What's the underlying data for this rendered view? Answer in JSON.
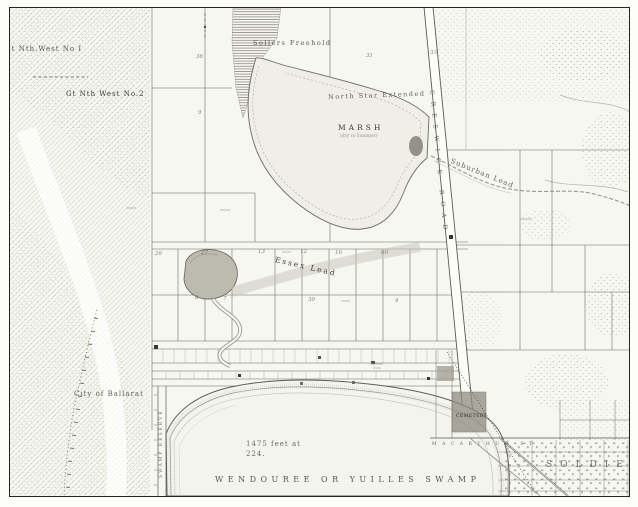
{
  "page": {
    "type": "scanned historical survey map"
  },
  "colors": {
    "paper": "#f7f7f2",
    "ink": "#3c3930",
    "faint_ink": "#6f6c62",
    "frame": "#26241f"
  },
  "map": {
    "labels": {
      "great_nth_west_1": "reat Nth.West No I",
      "gt_nth_west_2": "Gt Nth West No.2",
      "sollers_freehold": "Sollers Freehold",
      "north_star_extended": "North Star Extended",
      "marsh": "MARSH",
      "marsh_note": "(dry in Summer)",
      "suburban_lead": "Suburban Lead",
      "creswick_road": "CRESWICK ROAD",
      "essex_lead": "Essex Lead",
      "city_of_ballarat": "City of Ballarat",
      "elevation_line1": "1475 feet at",
      "elevation_line2": "224.",
      "wendouree_swamp": "WENDOUREE OR YUILLES SWAMP",
      "swamp_reserve": "SWAMP RESERVE",
      "cemetery": "CEMETERY",
      "macarthur_st": "MACARTHUR ST",
      "soldiers": "SOLDIERS"
    },
    "lot_numbers": [
      "36",
      "31",
      "33",
      "9",
      "26",
      "27",
      "13",
      "12",
      "16",
      "60",
      "8",
      "7",
      "30",
      "4"
    ]
  }
}
